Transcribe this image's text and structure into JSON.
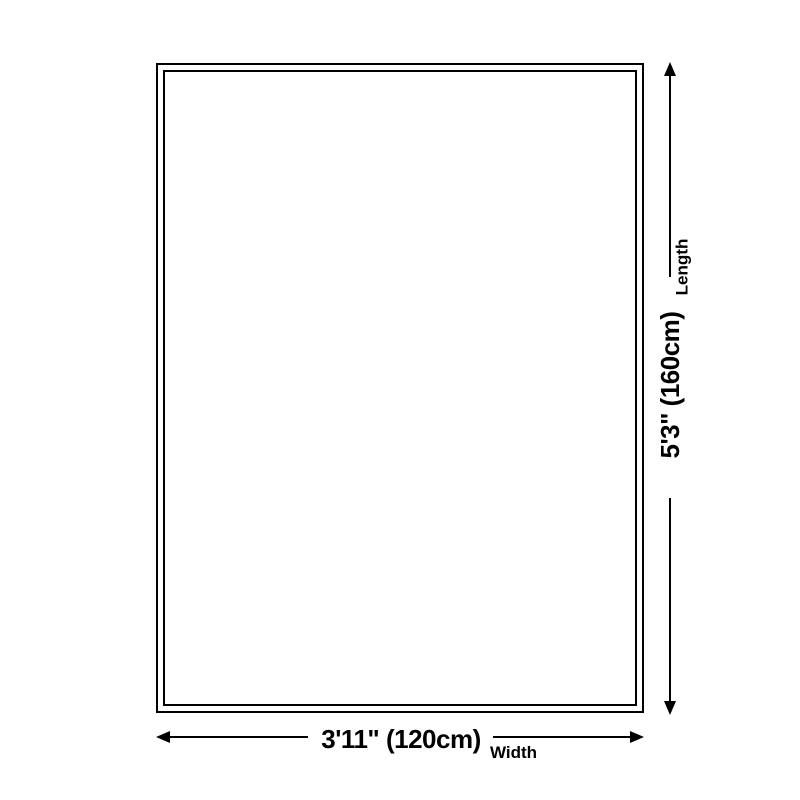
{
  "diagram": {
    "background_color": "#ffffff",
    "line_color": "#000000",
    "length": {
      "value": "5'3\" (160cm)",
      "label": "Length"
    },
    "width": {
      "value": "3'11\" (120cm)",
      "label": "Width"
    }
  }
}
